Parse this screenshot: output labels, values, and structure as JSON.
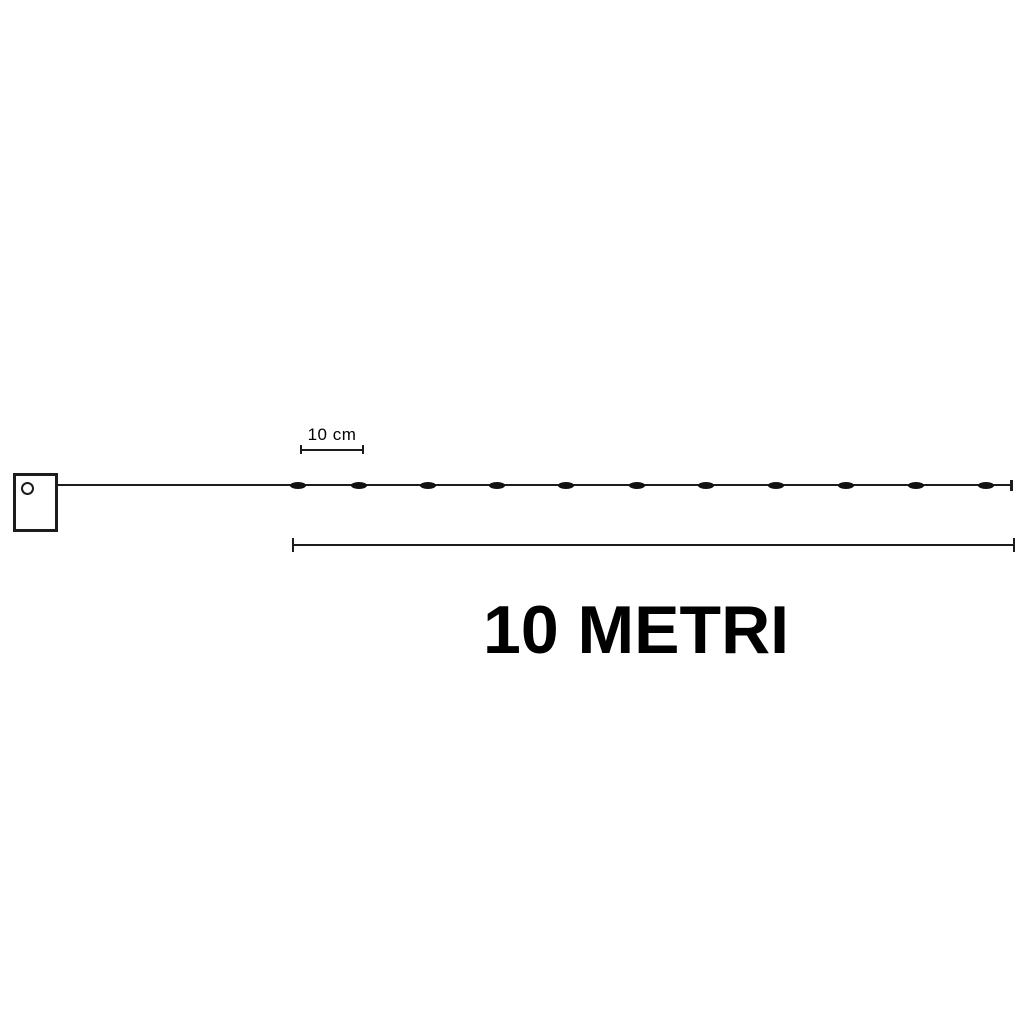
{
  "diagram": {
    "scale": {
      "label": "10 cm"
    },
    "length": {
      "label": "10 METRI"
    },
    "leds": {
      "count": 11,
      "positions_x": [
        298,
        359,
        428,
        497,
        566,
        637,
        706,
        776,
        846,
        916,
        986
      ],
      "center_y": 485,
      "width": 16,
      "height": 7
    },
    "colors": {
      "line": "#1c1c1c",
      "led": "#111111",
      "background": "#ffffff",
      "text": "#000000"
    }
  }
}
